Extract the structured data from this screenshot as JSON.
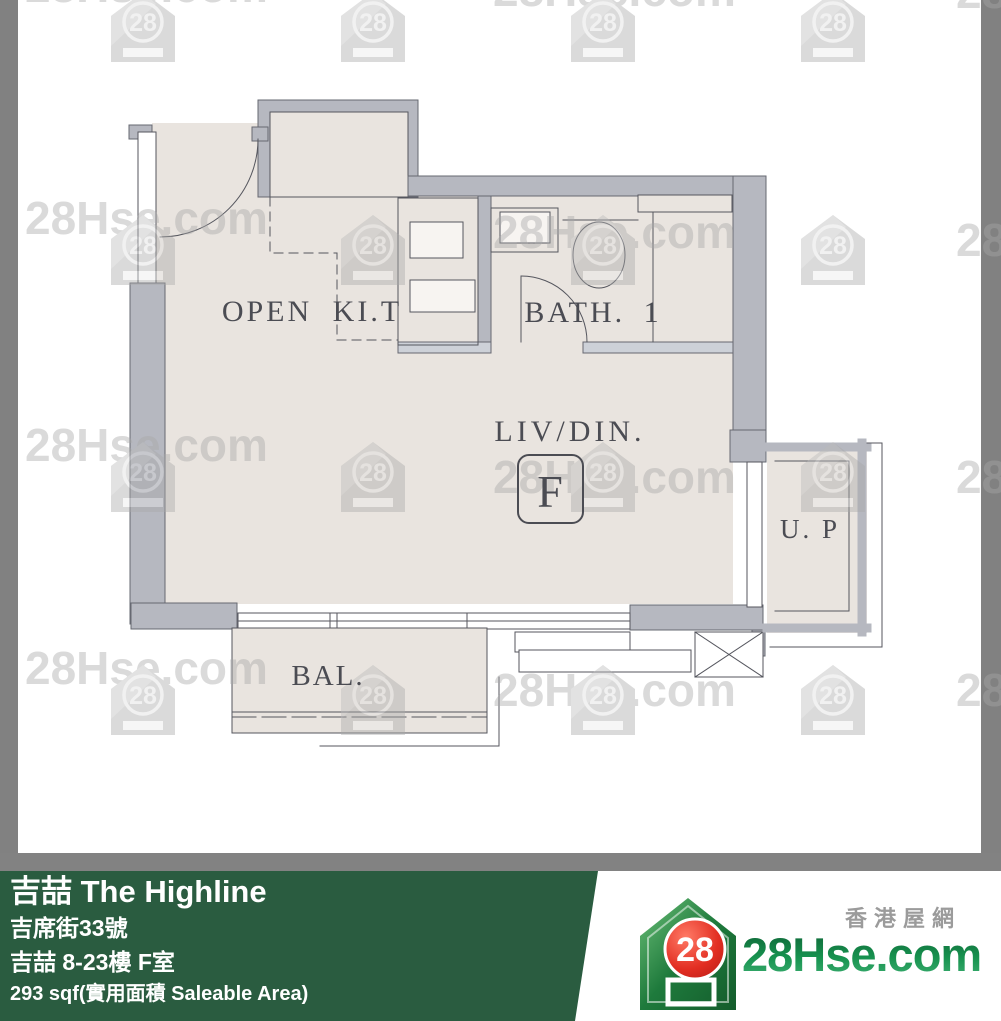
{
  "floor_plan": {
    "labels": {
      "open_kitchen": "OPEN KI.T",
      "bath": "BATH. 1",
      "living_dining": "LIV/DIN.",
      "unit_letter": "F",
      "utility_platform": "U. P",
      "balcony": "BAL."
    }
  },
  "watermark": {
    "text": "28Hse.com",
    "badge": "28"
  },
  "banner": {
    "building_name": "吉喆 The Highline",
    "address": "吉席街33號",
    "unit_info": "吉喆 8-23樓 F室",
    "area": "293 sqf(實用面積 Saleable Area)",
    "background_color": "#2a5c40"
  },
  "logo": {
    "badge": "28",
    "site_name": "28Hse.com",
    "tagline": "香港屋網",
    "green": "#17924f",
    "red": "#d62421"
  },
  "colors": {
    "floor_fill": "#e9e4df",
    "wall_fill": "#b6b8c0",
    "line": "#55565e",
    "frame_border": "#818181",
    "watermark_gray": "#a8a8a8"
  }
}
